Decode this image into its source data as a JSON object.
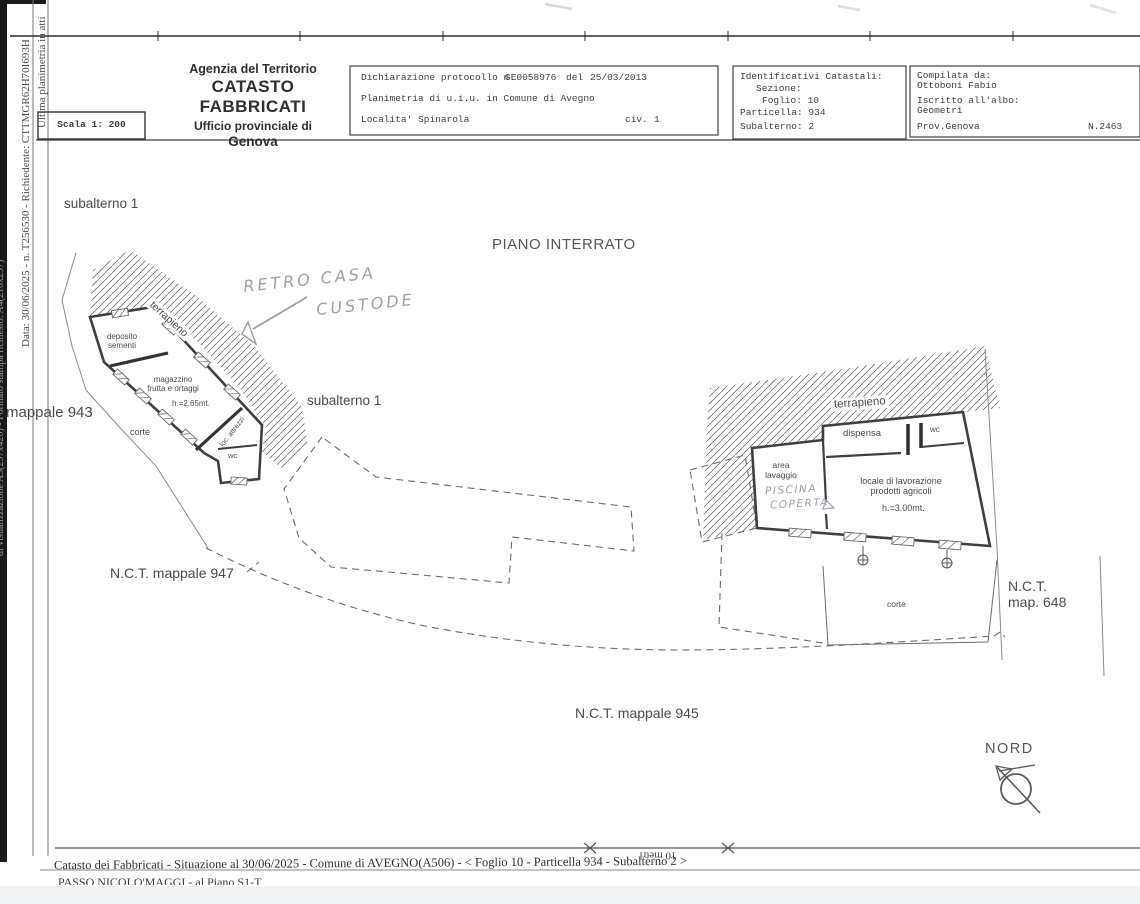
{
  "colors": {
    "ink": "#4a4a4a",
    "wall": "#3f3f3f",
    "pencil": "#99a1a9",
    "frame": "#2e2e2e",
    "scan_strip": "#1a1a1a"
  },
  "sidebar": {
    "line1": "Ultima planimetria in atti",
    "line2": "Data: 30/06/2025 - n. T256530 - Richiedente: CTTMGR62H70I693H",
    "line3_partial": "di visualizzazione A3(297x420) - Formato stampa richiesto: A4(210x297)"
  },
  "header": {
    "agency_line1": "Agenzia del Territorio",
    "agency_line2": "CATASTO FABBRICATI",
    "agency_line3": "Ufficio provinciale di",
    "agency_line4": "Genova",
    "scale_label": "Scala 1: 200",
    "declaration": {
      "protocol_label": "Dichiarazione protocollo n.",
      "protocol_number": "GE0058976",
      "del_label": "del",
      "protocol_date": "25/03/2013",
      "planimetria_line": "Planimetria di u.i.u. in Comune di Avegno",
      "localita_line": "Localita' Spinarola",
      "civ_label": "civ.",
      "civ_value": "1"
    },
    "cadastral": {
      "title": "Identificativi Catastali:",
      "sezione": "Sezione:",
      "foglio": "Foglio: 10",
      "particella": "Particella: 934",
      "subalterno": "Subalterno: 2"
    },
    "compiled": {
      "title": "Compilata da:",
      "name": "Ottoboni Fabio",
      "albo_label": "Iscritto all'albo:",
      "albo_value": "Geometri",
      "province": "Prov.Genova",
      "number": "N.2463"
    }
  },
  "plan": {
    "floor_title": "PIANO INTERRATO",
    "subalterno_left": "subalterno 1",
    "subalterno_center": "subalterno 1",
    "terrapieno_left": "terrapieno",
    "terrapieno_right": "terrapieno",
    "left_building": {
      "deposito": "deposito\nsementi",
      "magazzino": "magazzino\nfrutta e ortaggi",
      "magazzino_height": "h.=2.65mt.",
      "loc_attrezzi": "loc. attrezzi",
      "wc": "wc",
      "corte": "corte"
    },
    "right_building": {
      "dispensa": "dispensa",
      "wc": "wc",
      "area_lavaggio": "area\nlavaggio",
      "locale": "locale di lavorazione\nprodotti agricoli",
      "locale_height": "h.=3.00mt.",
      "corte": "corte"
    },
    "parcels": {
      "mappale_943": "mappale 943",
      "nct_947": "N.C.T. mappale 947",
      "nct_945": "N.C.T. mappale 945",
      "nct_648_line1": "N.C.T.",
      "nct_648_line2": "map. 648"
    },
    "handwritten": {
      "note1_line1": "RETRO CASA",
      "note1_line2": "CUSTODE",
      "note2_line1": "PISCINA",
      "note2_line2": "COPERTA"
    },
    "north_label": "NORD",
    "scalebar_label": "10 metri"
  },
  "footer": {
    "line1": "Catasto dei Fabbricati - Situazione al 30/06/2025 - Comune di AVEGNO(A506) - < Foglio 10 - Particella 934 - Subalterno 2 >",
    "line2_truncated": "PASSO NICOLO'MAGGI - al Piano S1-T"
  }
}
